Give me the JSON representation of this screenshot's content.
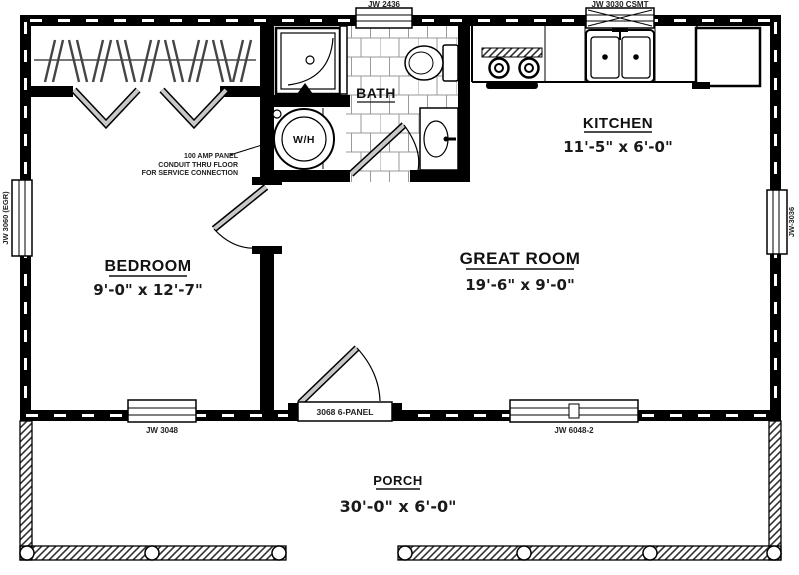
{
  "plan": {
    "rooms": {
      "bedroom": {
        "name": "BEDROOM",
        "dims": "9'-0\" x 12'-7\""
      },
      "great_room": {
        "name": "GREAT ROOM",
        "dims": "19'-6\" x 9'-0\""
      },
      "kitchen": {
        "name": "KITCHEN",
        "dims": "11'-5\" x 6'-0\""
      },
      "bath": {
        "name": "BATH"
      },
      "porch": {
        "name": "PORCH",
        "dims": "30'-0\" x 6'-0\""
      }
    },
    "fixtures": {
      "water_heater_label": "W/H"
    },
    "windows": {
      "top_bath": "JW 2436",
      "top_kitchen": "JW 3030 CSMT",
      "left_bedroom": "JW 3060 (EGR)",
      "right_great_room": "JW-3036",
      "bottom_bedroom": "JW 3048",
      "bottom_great_room": "JW 6048-2"
    },
    "doors": {
      "entry": "3068 6-PANEL"
    },
    "notes": {
      "electrical_line1": "100 AMP PANEL",
      "electrical_line2": "CONDUIT THRU FLOOR",
      "electrical_line3": "FOR SERVICE CONNECTION"
    },
    "colors": {
      "wall": "#000000",
      "door_panel": "#c8c8c8",
      "tile_line": "#9a9a9a"
    }
  }
}
